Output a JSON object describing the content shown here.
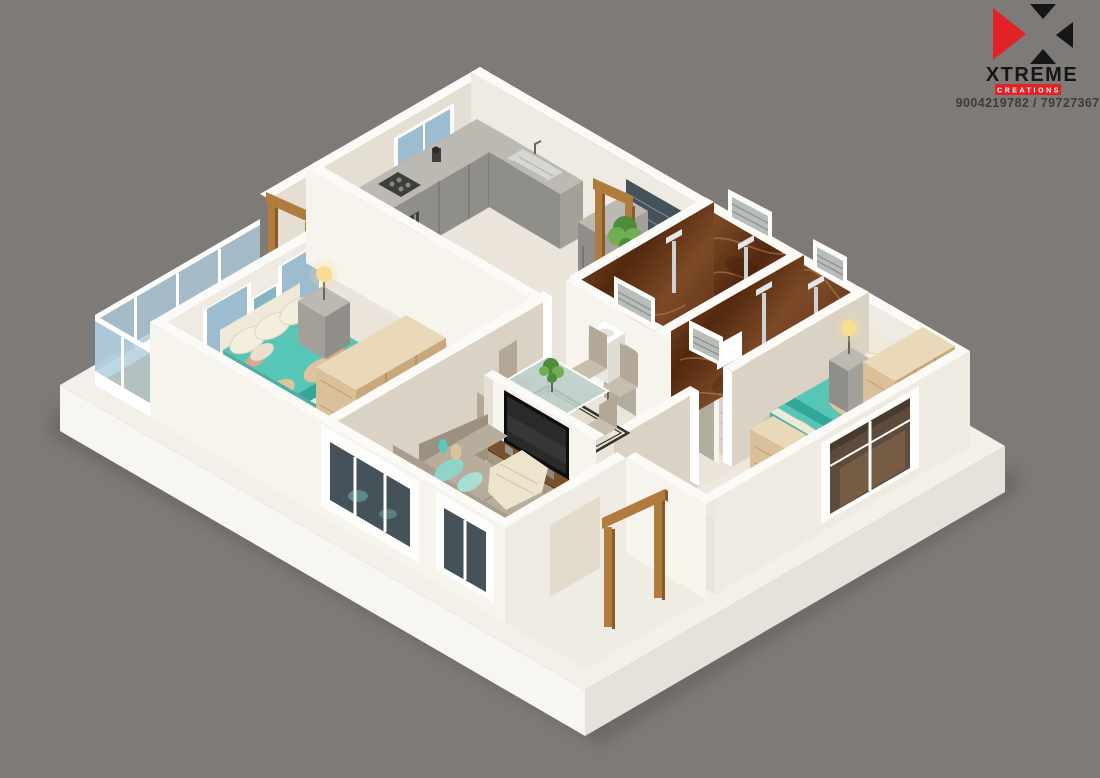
{
  "branding": {
    "company": "XTREME",
    "tagline": "CREATIONS",
    "phone": "9004219782 / 7972736715",
    "logo_mark": "x-of-four-triangles"
  },
  "scene": {
    "type": "3d-isometric-floor-plan-render",
    "rooms": [
      "balcony",
      "bedroom-1",
      "kitchen",
      "utility-passage",
      "bathroom-1",
      "bathroom-2",
      "living-dining",
      "bedroom-2",
      "entrance-porch"
    ],
    "furniture": [
      "double-bed-teal-floral",
      "wardrobe",
      "nightstand-with-lamp",
      "kitchen-l-counter",
      "refrigerator",
      "wall-hung-toilet",
      "shower",
      "dining-table-glass-6-chairs",
      "l-shaped-sofa",
      "round-coffee-table",
      "tv-console-with-tv",
      "plants"
    ]
  },
  "palette": {
    "bg": "#7d7a78",
    "shadow": "#4e4b4a",
    "base-top": "#f3f0ea",
    "base-left": "#f8f6f2",
    "base-right": "#e5e2dc",
    "porch": "#efece4",
    "floor": "#eae4da",
    "tile": "#d7d3ca",
    "tile-line": "#c2bdb2",
    "deck": "#c79a63",
    "deck-line": "#b0854f",
    "wall-bright": "#f7f4ee",
    "wall-light": "#efebe2",
    "wall-mid": "#e4ded3",
    "wall-shade": "#d9d2c5",
    "wall-top": "#fbfaf7",
    "marble-hi": "#8a5731",
    "marble-mid": "#7c4a26",
    "marble-lo": "#53280f",
    "marble-vein": "#c89a6a",
    "glass-blue": "#9dbccf",
    "glass-rail": "#aecbdb",
    "glass-dark": "#46525a",
    "glass-warm": "#5d4c3c",
    "frame-white": "#fdfdfc",
    "wood": "#b07c3e",
    "wood-dark": "#875c2a",
    "wood-grain": "#b8955f",
    "wood-light": "#d9c09a",
    "wood-light2": "#c9a97c",
    "wood-top": "#e9d9ba",
    "counter-top": "#bcb9b3",
    "counter-face": "#908e88",
    "counter-side": "#a3a09a",
    "steel": "#d6d6d3",
    "appliance": "#3f3e3c",
    "teal": "#57c6b7",
    "teal-deep": "#2fa496",
    "patch-beige": "#dec39e",
    "patch-pink": "#d9a88f",
    "pillow": "#f4eedd",
    "sheet": "#efe9da",
    "sheet2": "#e4ddcb",
    "sofa-back": "#a99d8d",
    "sofa-seat": "#b8ac9c",
    "sofa-side": "#9c9081",
    "cushion": "#8fd4c8",
    "throw": "#ede4cd",
    "walnut": "#5f3f23",
    "walnut-top": "#76512e",
    "tv": "#0e0e0e",
    "chair": "#c8bead",
    "chair-back": "#b3a795",
    "table-glass": "#bccfca",
    "rug-dark": "#35322e",
    "rug-light": "#ddd3c0",
    "plant-a": "#4e8c3c",
    "plant-b": "#6fae52",
    "lamp-glow": "#f9dd95",
    "lamp-metal": "#6b655e",
    "toilet-shadow": "#d8d5cf",
    "logo-red": "#e32227",
    "logo-black": "#161616",
    "text-dark": "#3c3c3c"
  }
}
